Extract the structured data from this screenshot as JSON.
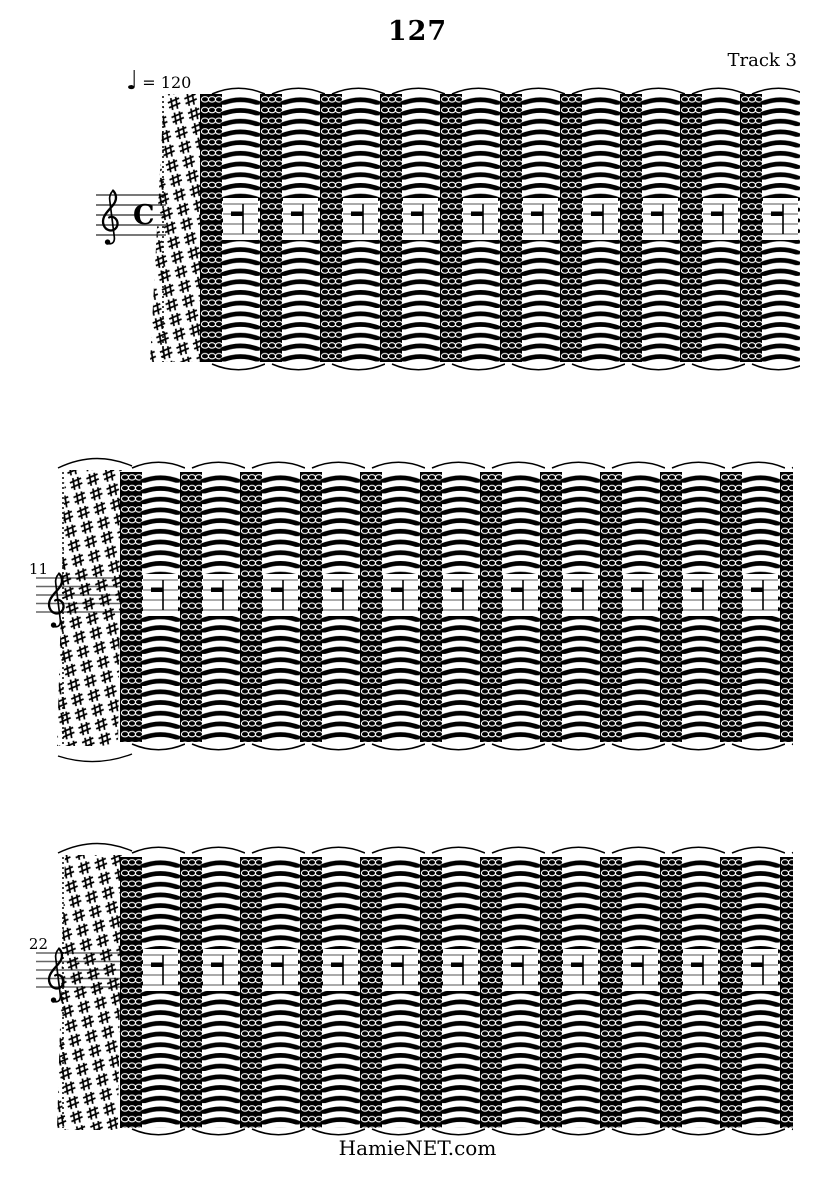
{
  "page": {
    "title": "127",
    "track_label": "Track 3",
    "footer": "HamieNET.com"
  },
  "tempo": {
    "note_glyph": "♩",
    "marking": "= 120"
  },
  "systems": [
    {
      "index": 1,
      "clef": "treble",
      "time_signature": "C",
      "first_measure": ""
    },
    {
      "index": 2,
      "clef": "treble",
      "first_measure": "11"
    },
    {
      "index": 3,
      "clef": "treble",
      "first_measure": "22"
    }
  ],
  "colors": {
    "ink": "#000000",
    "paper": "#ffffff",
    "staff_line": "#666666"
  }
}
